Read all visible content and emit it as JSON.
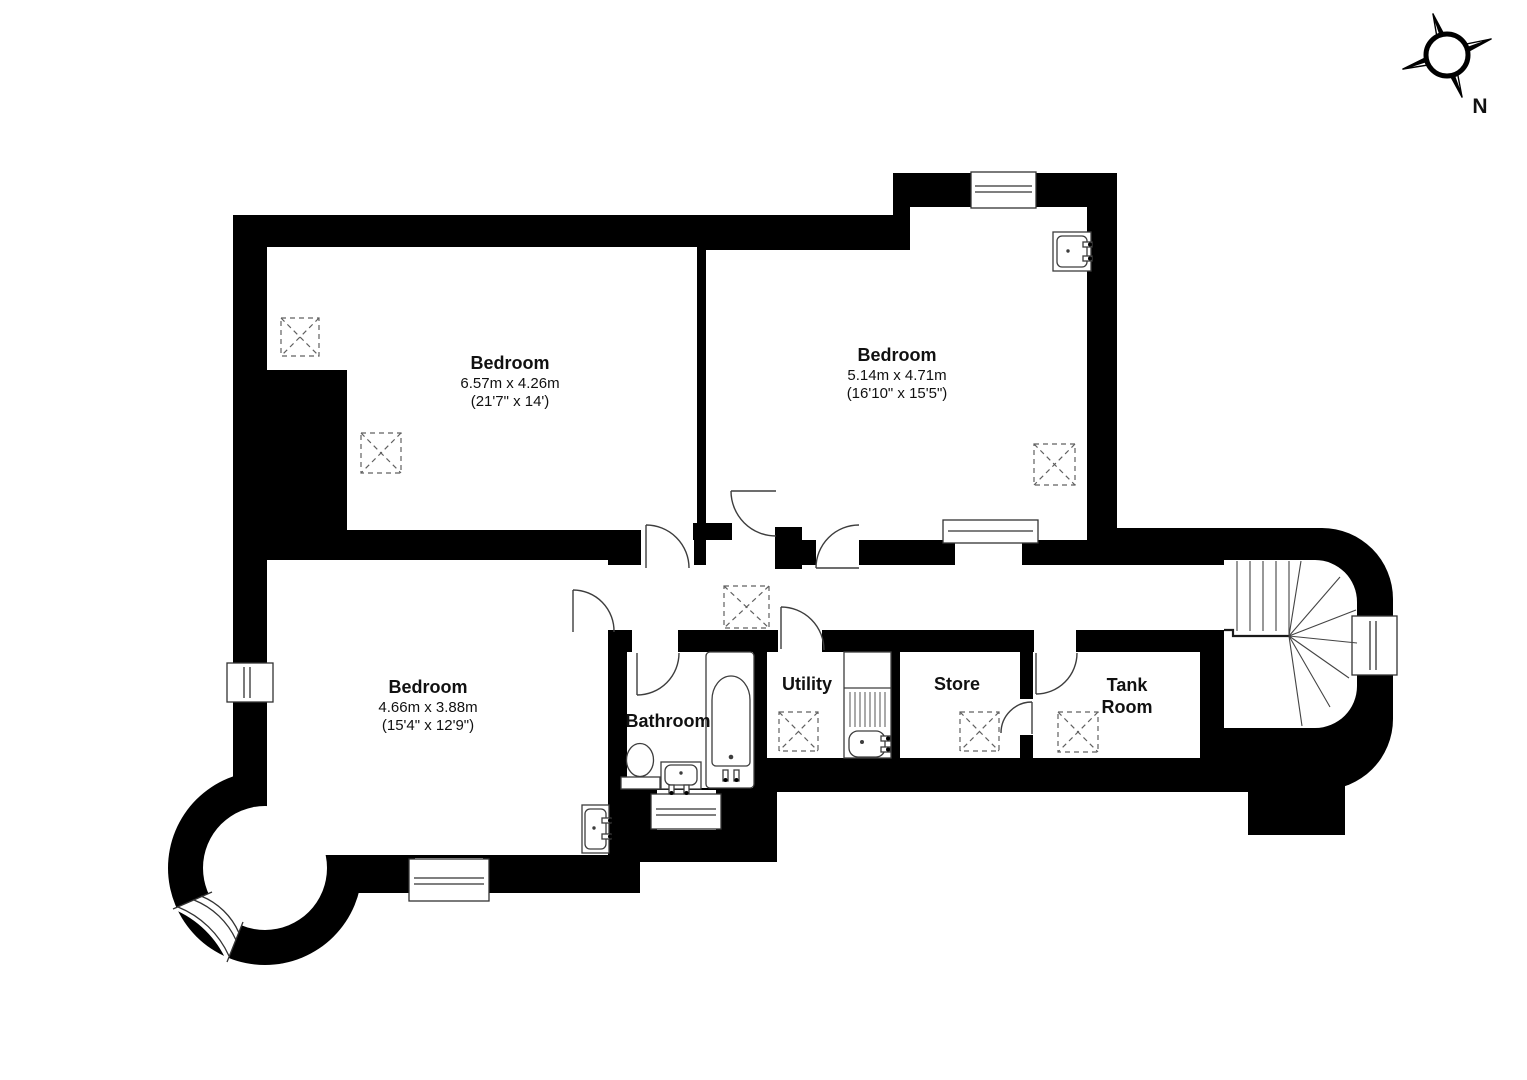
{
  "compass": {
    "label": "N"
  },
  "rooms": [
    {
      "name": "Bedroom",
      "dim_m": "6.57m x 4.26m",
      "dim_ft": "(21'7\" x 14')"
    },
    {
      "name": "Bedroom",
      "dim_m": "5.14m x 4.71m",
      "dim_ft": "(16'10\" x 15'5\")"
    },
    {
      "name": "Bedroom",
      "dim_m": "4.66m x 3.88m",
      "dim_ft": "(15'4\" x 12'9\")"
    },
    {
      "name": "Bathroom"
    },
    {
      "name": "Utility"
    },
    {
      "name": "Store"
    },
    {
      "name": "Tank",
      "name2": "Room"
    }
  ],
  "colors": {
    "walls": "#000000",
    "background": "#ffffff",
    "fixture_line": "#3d3d3d",
    "symbol_dash": "#606060"
  }
}
